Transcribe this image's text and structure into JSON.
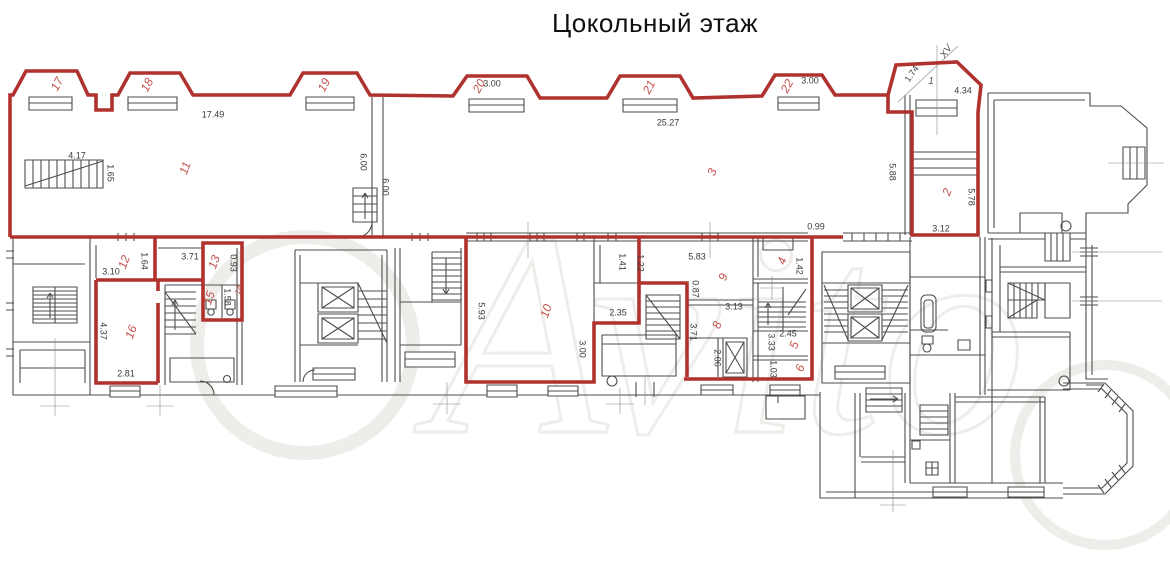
{
  "title": "Цокольный этаж",
  "watermark": "Avito",
  "colors": {
    "apartment_outline": "#b0322f",
    "wall": "#4d4d4d",
    "dimension_text": "#3a3a3a",
    "room_number_text": "#c4534d"
  },
  "room_labels": [
    {
      "text": "17",
      "x": 57,
      "y": 84,
      "rot": -62
    },
    {
      "text": "18",
      "x": 147,
      "y": 85,
      "rot": -62
    },
    {
      "text": "19",
      "x": 324,
      "y": 85,
      "rot": -62
    },
    {
      "text": "20",
      "x": 479,
      "y": 86,
      "rot": -62
    },
    {
      "text": "21",
      "x": 649,
      "y": 87,
      "rot": -62
    },
    {
      "text": "22",
      "x": 787,
      "y": 86,
      "rot": -62
    },
    {
      "text": "11",
      "x": 185,
      "y": 168,
      "rot": -70
    },
    {
      "text": "3",
      "x": 712,
      "y": 172,
      "rot": -70
    },
    {
      "text": "2",
      "x": 947,
      "y": 192,
      "rot": -70
    },
    {
      "text": "12",
      "x": 124,
      "y": 262,
      "rot": -70
    },
    {
      "text": "13",
      "x": 214,
      "y": 262,
      "rot": -70
    },
    {
      "text": "14",
      "x": 239,
      "y": 290,
      "rot": -70,
      "size": 8
    },
    {
      "text": "15",
      "x": 209,
      "y": 298,
      "rot": -70
    },
    {
      "text": "16",
      "x": 131,
      "y": 332,
      "rot": -70
    },
    {
      "text": "10",
      "x": 546,
      "y": 311,
      "rot": -70
    },
    {
      "text": "9",
      "x": 723,
      "y": 277,
      "rot": -70
    },
    {
      "text": "8",
      "x": 717,
      "y": 325,
      "rot": -70
    },
    {
      "text": "4",
      "x": 782,
      "y": 261,
      "rot": -70
    },
    {
      "text": "5",
      "x": 794,
      "y": 345,
      "rot": -70
    },
    {
      "text": "6",
      "x": 800,
      "y": 368,
      "rot": -70
    }
  ],
  "dimension_labels": [
    {
      "text": "17.49",
      "x": 213,
      "y": 115,
      "rot": 0
    },
    {
      "text": "3.00",
      "x": 492,
      "y": 84,
      "rot": 0
    },
    {
      "text": "25.27",
      "x": 668,
      "y": 123,
      "rot": 0
    },
    {
      "text": "3.00",
      "x": 810,
      "y": 81,
      "rot": 0
    },
    {
      "text": "4.34",
      "x": 963,
      "y": 91,
      "rot": 0
    },
    {
      "text": "1.74",
      "x": 912,
      "y": 74,
      "rot": -55
    },
    {
      "text": "4.17",
      "x": 77,
      "y": 156,
      "rot": 0
    },
    {
      "text": "1.65",
      "x": 110,
      "y": 173,
      "rot": 90
    },
    {
      "text": "6.00",
      "x": 363,
      "y": 162,
      "rot": 90
    },
    {
      "text": "6.00",
      "x": 385,
      "y": 187,
      "rot": 90
    },
    {
      "text": "5.88",
      "x": 892,
      "y": 172,
      "rot": 90
    },
    {
      "text": "5.78",
      "x": 971,
      "y": 197,
      "rot": 90
    },
    {
      "text": "3.12",
      "x": 941,
      "y": 229,
      "rot": 0
    },
    {
      "text": "0.99",
      "x": 816,
      "y": 227,
      "rot": 0
    },
    {
      "text": "1.64",
      "x": 144,
      "y": 261,
      "rot": 90
    },
    {
      "text": "3.10",
      "x": 111,
      "y": 272,
      "rot": 0
    },
    {
      "text": "3.71",
      "x": 190,
      "y": 257,
      "rot": 0
    },
    {
      "text": "0.93",
      "x": 233,
      "y": 263,
      "rot": 90
    },
    {
      "text": "1.58",
      "x": 227,
      "y": 297,
      "rot": 90
    },
    {
      "text": "4.37",
      "x": 103,
      "y": 331,
      "rot": 90
    },
    {
      "text": "2.81",
      "x": 126,
      "y": 374,
      "rot": 0
    },
    {
      "text": "5.93",
      "x": 481,
      "y": 311,
      "rot": 90
    },
    {
      "text": "2.35",
      "x": 618,
      "y": 313,
      "rot": 0
    },
    {
      "text": "3.00",
      "x": 582,
      "y": 349,
      "rot": 90
    },
    {
      "text": "1.41",
      "x": 622,
      "y": 262,
      "rot": 90
    },
    {
      "text": "1.22",
      "x": 640,
      "y": 263,
      "rot": 90
    },
    {
      "text": "5.83",
      "x": 697,
      "y": 257,
      "rot": 0
    },
    {
      "text": "0.87",
      "x": 695,
      "y": 289,
      "rot": 90
    },
    {
      "text": "3.13",
      "x": 734,
      "y": 307,
      "rot": 0
    },
    {
      "text": "3.71",
      "x": 693,
      "y": 332,
      "rot": 90
    },
    {
      "text": "2.06",
      "x": 717,
      "y": 358,
      "rot": 90
    },
    {
      "text": "1.42",
      "x": 799,
      "y": 266,
      "rot": 90
    },
    {
      "text": "2.45",
      "x": 788,
      "y": 334,
      "rot": 0
    },
    {
      "text": "3.33",
      "x": 771,
      "y": 342,
      "rot": 90
    },
    {
      "text": "1.03",
      "x": 773,
      "y": 369,
      "rot": 90
    }
  ],
  "axis_labels": [
    {
      "text": "XV",
      "x": 947,
      "y": 52,
      "rot": -55
    },
    {
      "text": "1",
      "x": 931,
      "y": 82,
      "rot": 0
    }
  ]
}
